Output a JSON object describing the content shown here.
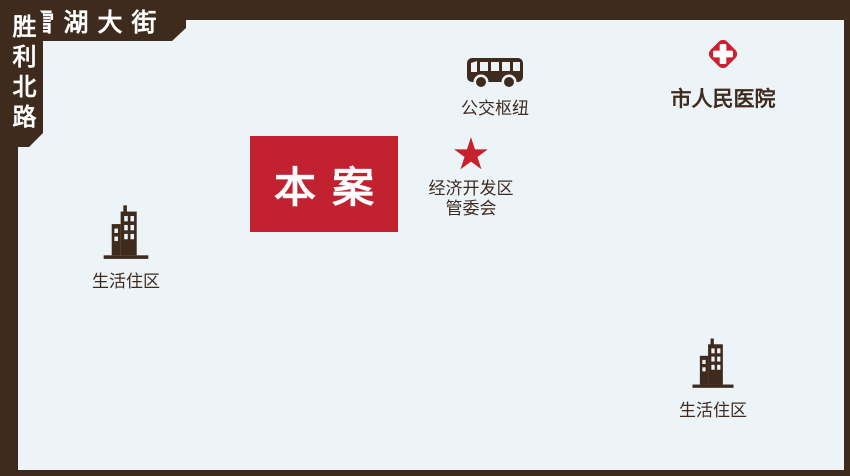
{
  "colors": {
    "background": "#EDF4F8",
    "road": "#3F2A1E",
    "accent_red": "#C2212F"
  },
  "site": {
    "label": "本案"
  },
  "streets": {
    "yingmou_west_street": "嬴牟西大街",
    "xuehu_street": "雪湖大街",
    "guihua_road": "规划路",
    "beitan_north_road": "北坛北路",
    "shengli_north_road": "胜利北路"
  },
  "pois": {
    "bus_hub": {
      "label": "公交枢纽"
    },
    "hospital": {
      "label": "市人民医院"
    },
    "edz_committee": {
      "line1": "经济开发区",
      "line2": "管委会"
    },
    "residential_west": {
      "label": "生活住区"
    },
    "residential_east": {
      "label": "生活住区"
    },
    "star_glyph": "★"
  }
}
